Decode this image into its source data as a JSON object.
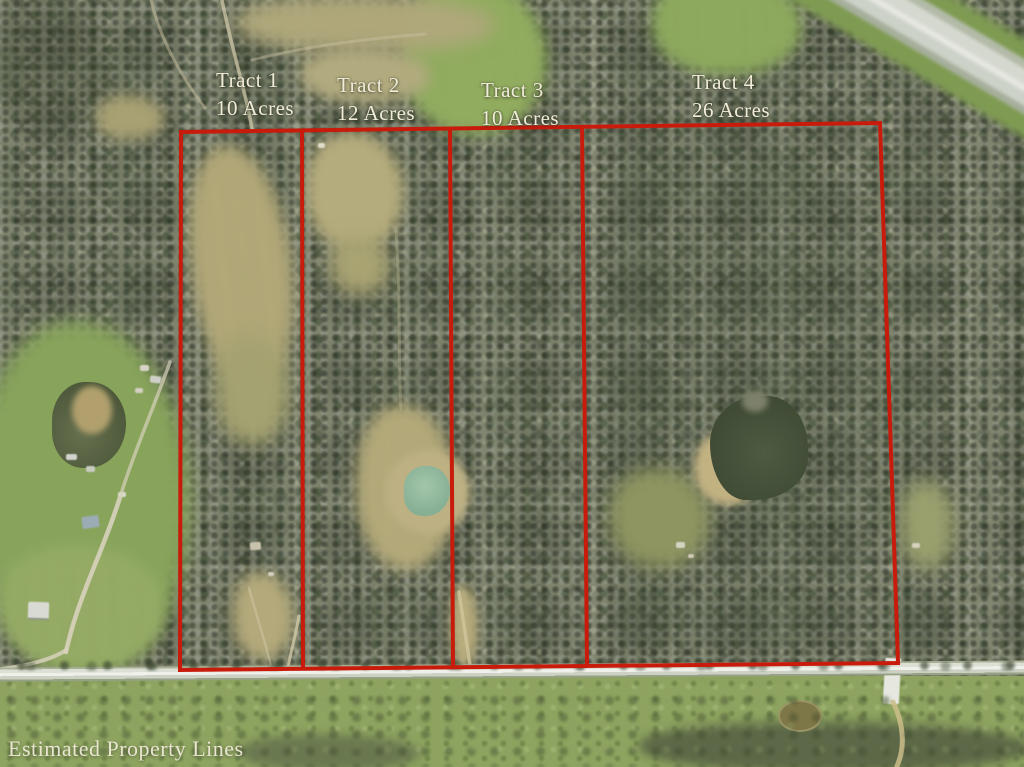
{
  "scene": {
    "description": "Aerial photograph of wooded acreage with estimated property lines drawn in red over four tracts, bordered by a county road at the bottom and a highway at the top right",
    "caption": "Estimated Property Lines"
  },
  "tracts": [
    {
      "name": "Tract 1",
      "acreage": "10 Acres"
    },
    {
      "name": "Tract 2",
      "acreage": "12 Acres"
    },
    {
      "name": "Tract 3",
      "acreage": "10 Acres"
    },
    {
      "name": "Tract 4",
      "acreage": "26 Acres"
    }
  ],
  "colors": {
    "boundary_red": "#c91b0c",
    "label_text": "#f1ecda"
  }
}
